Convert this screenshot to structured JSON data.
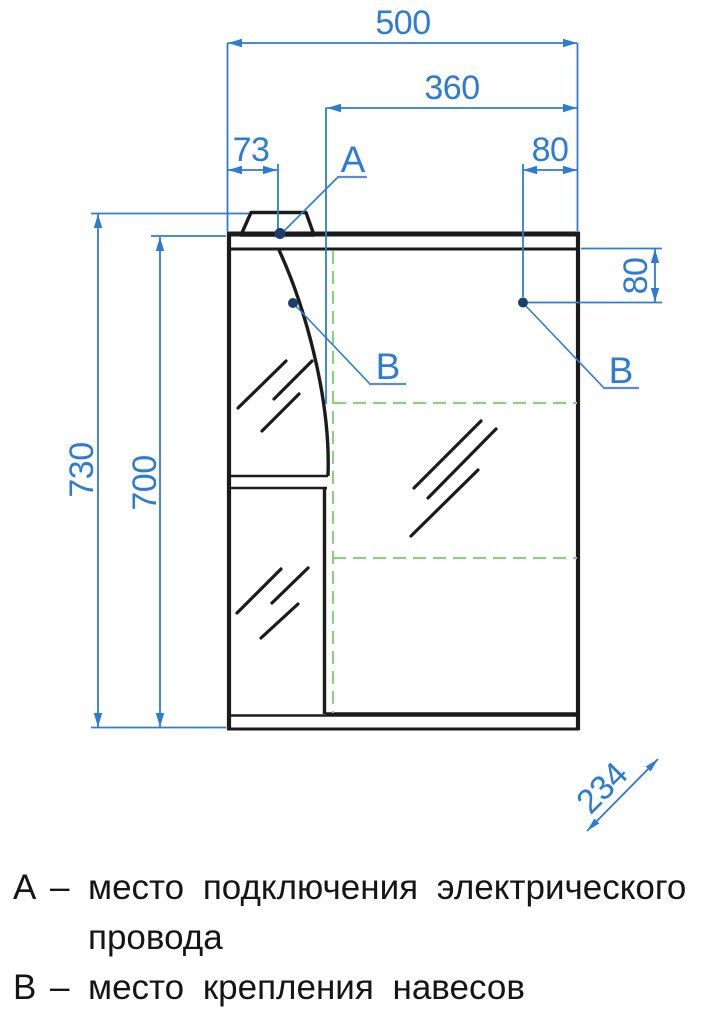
{
  "drawing": {
    "dimensions": {
      "total_width": "500",
      "mirror_width": "360",
      "left_offset": "73",
      "right_offset": "80",
      "right_vertical_offset": "80",
      "total_height": "730",
      "body_height": "700",
      "depth": "234"
    },
    "markers": {
      "a": "А",
      "b_left": "В",
      "b_right": "В"
    },
    "colors": {
      "dimension_blue": "#2e7cd2",
      "marker_dot_navy": "#1c3e6d",
      "mirror_outline_green": "#8fd080",
      "drawing_black": "#1b1b1b"
    }
  },
  "legend": {
    "items": [
      {
        "key": "А",
        "dash": "–",
        "text": "место подключения электрического провода"
      },
      {
        "key": "В",
        "dash": "–",
        "text": "место крепления навесов"
      }
    ]
  }
}
